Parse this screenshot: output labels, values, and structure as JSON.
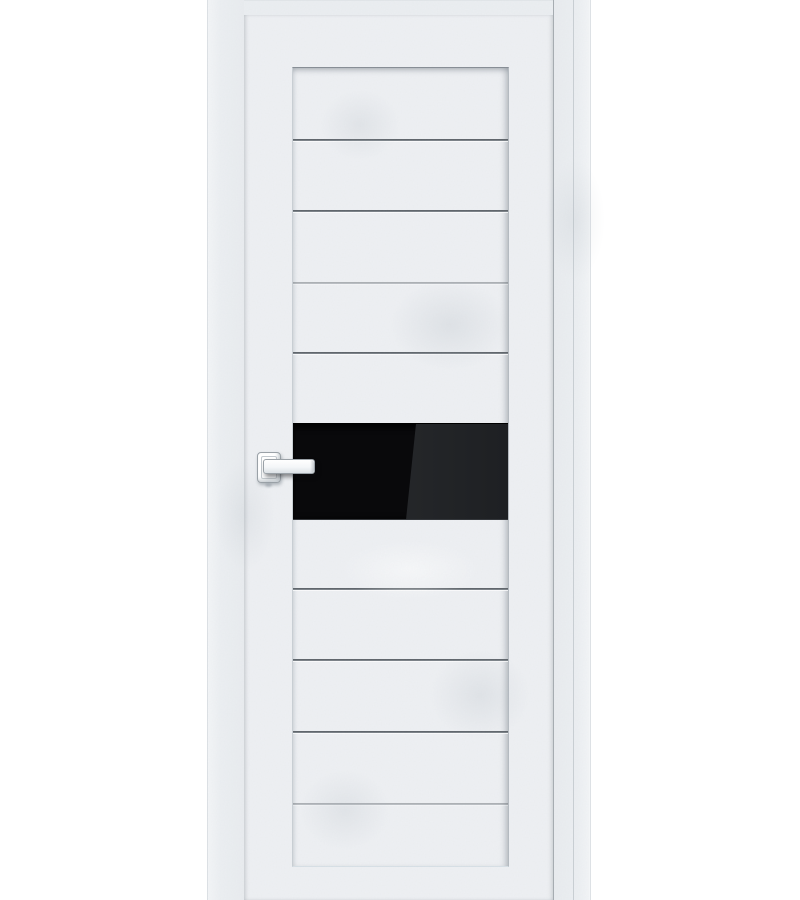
{
  "image": {
    "alt": "White concrete-textured interior door with horizontal grooves, black gloss glass insert and white square-rose lever handle, shown in a white door frame on a white background",
    "visible_text": []
  },
  "door": {
    "parts": {
      "frame": "door-frame",
      "leaf": "door-leaf",
      "panel": "grooved-center-panel",
      "glass": "black-gloss-glass-insert",
      "handle": "white-lever-handle"
    },
    "groove_count": 8
  },
  "colors": {
    "background": "#ffffff",
    "door_surface": "#eef0f3",
    "frame_surface": "#ebeef1",
    "groove_dark": "#50555b",
    "glass_black": "#09090b",
    "glass_reflection": "#232528",
    "handle_white": "#ffffff",
    "edge_line": "#8f959b",
    "panel_bottom_highlight": "#d7e0e6"
  }
}
